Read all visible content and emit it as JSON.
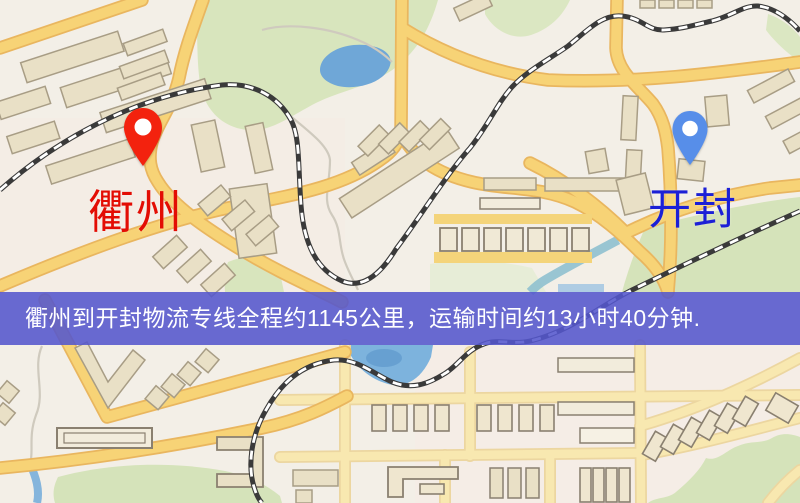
{
  "markers": {
    "origin": {
      "name": "衢州",
      "label_color": "#e30d04",
      "pin_color": "#f3220e"
    },
    "destination": {
      "name": "开封",
      "label_color": "#1c20d6",
      "pin_color": "#578ee9"
    }
  },
  "banner": {
    "text": "衢州到开封物流专线全程约1145公里，运输时间约13小时40分钟.",
    "background": "#5457cd",
    "text_color": "#ffffff"
  },
  "route": {
    "distance_km": "1145",
    "duration": "13小时40分钟"
  },
  "map_palette": {
    "background": "#f3efe7",
    "road_major": "#f7d376",
    "road_minor": "#f8e8b0",
    "building": "#e9e0c6",
    "green_area": "#d8e5bd",
    "water": "#7db3dd",
    "railway": "#3a3a3a"
  }
}
